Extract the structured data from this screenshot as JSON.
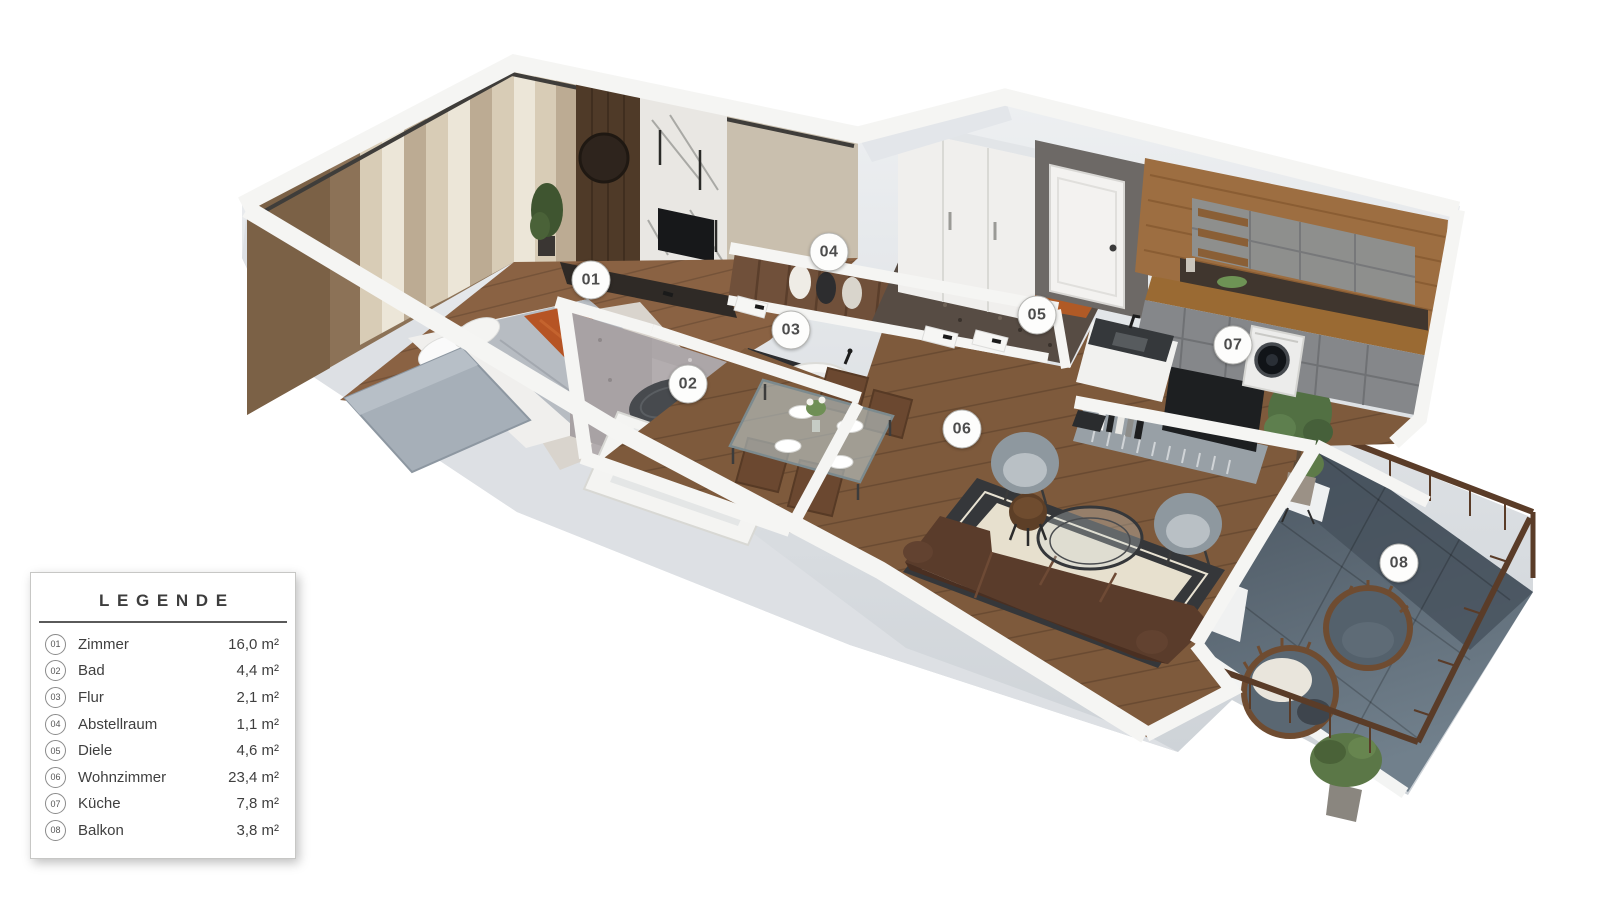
{
  "legend": {
    "title": "LEGENDE",
    "rows": [
      {
        "num": "01",
        "label": "Zimmer",
        "area": "16,0 m²"
      },
      {
        "num": "02",
        "label": "Bad",
        "area": "4,4 m²"
      },
      {
        "num": "03",
        "label": "Flur",
        "area": "2,1 m²"
      },
      {
        "num": "04",
        "label": "Abstellraum",
        "area": "1,1 m²"
      },
      {
        "num": "05",
        "label": "Diele",
        "area": "4,6 m²"
      },
      {
        "num": "06",
        "label": "Wohnzimmer",
        "area": "23,4 m²"
      },
      {
        "num": "07",
        "label": "Küche",
        "area": "7,8 m²"
      },
      {
        "num": "08",
        "label": "Balkon",
        "area": "3,8 m²"
      }
    ]
  },
  "badges": [
    {
      "num": "01",
      "x": 591,
      "y": 280
    },
    {
      "num": "02",
      "x": 688,
      "y": 384
    },
    {
      "num": "03",
      "x": 791,
      "y": 330
    },
    {
      "num": "04",
      "x": 829,
      "y": 252
    },
    {
      "num": "05",
      "x": 1037,
      "y": 315
    },
    {
      "num": "06",
      "x": 962,
      "y": 429
    },
    {
      "num": "07",
      "x": 1233,
      "y": 345
    },
    {
      "num": "08",
      "x": 1399,
      "y": 563
    }
  ],
  "palette": {
    "accent_orange": "#b05a26",
    "wood_floor": "#85603e",
    "wall_white": "#f4f4f2",
    "terrazzo_grey": "#b3adaf",
    "balcony_grey": "#55616c",
    "sofa_brown": "#57392a",
    "cabinet_grey": "#8b8d8c"
  }
}
